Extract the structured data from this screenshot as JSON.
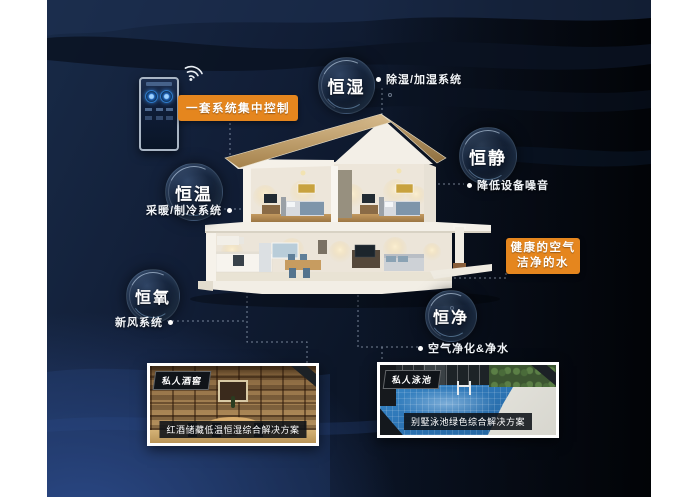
{
  "bubbles": [
    {
      "label": "恒湿",
      "desc": "除湿/加湿系统"
    },
    {
      "label": "恒静",
      "desc": "降低设备噪音"
    },
    {
      "label": "恒温",
      "desc": "采暖/制冷系统"
    },
    {
      "label": "恒氧",
      "desc": "新风系统"
    },
    {
      "label": "恒净",
      "desc": "空气净化&净水"
    }
  ],
  "callouts": {
    "control": "一套系统集中控制",
    "healthy_air": "健康的空气",
    "clean_water": "洁净的水"
  },
  "cards": [
    {
      "tag": "私人酒窖",
      "caption": "红酒储藏低温恒湿综合解决方案"
    },
    {
      "tag": "私人泳池",
      "caption": "别墅泳池绿色综合解决方案"
    }
  ],
  "icons": {
    "wifi": "wifi-icon",
    "connector_dot": "connector-dot"
  },
  "colors": {
    "accent_orange": "#e5861e",
    "background_navy": "#0c1628",
    "background_blue_glow": "#2d4b8c",
    "roof_tan": "#c9a870",
    "pool_blue": "#2e77b8",
    "wood_brown": "#ab8756"
  }
}
